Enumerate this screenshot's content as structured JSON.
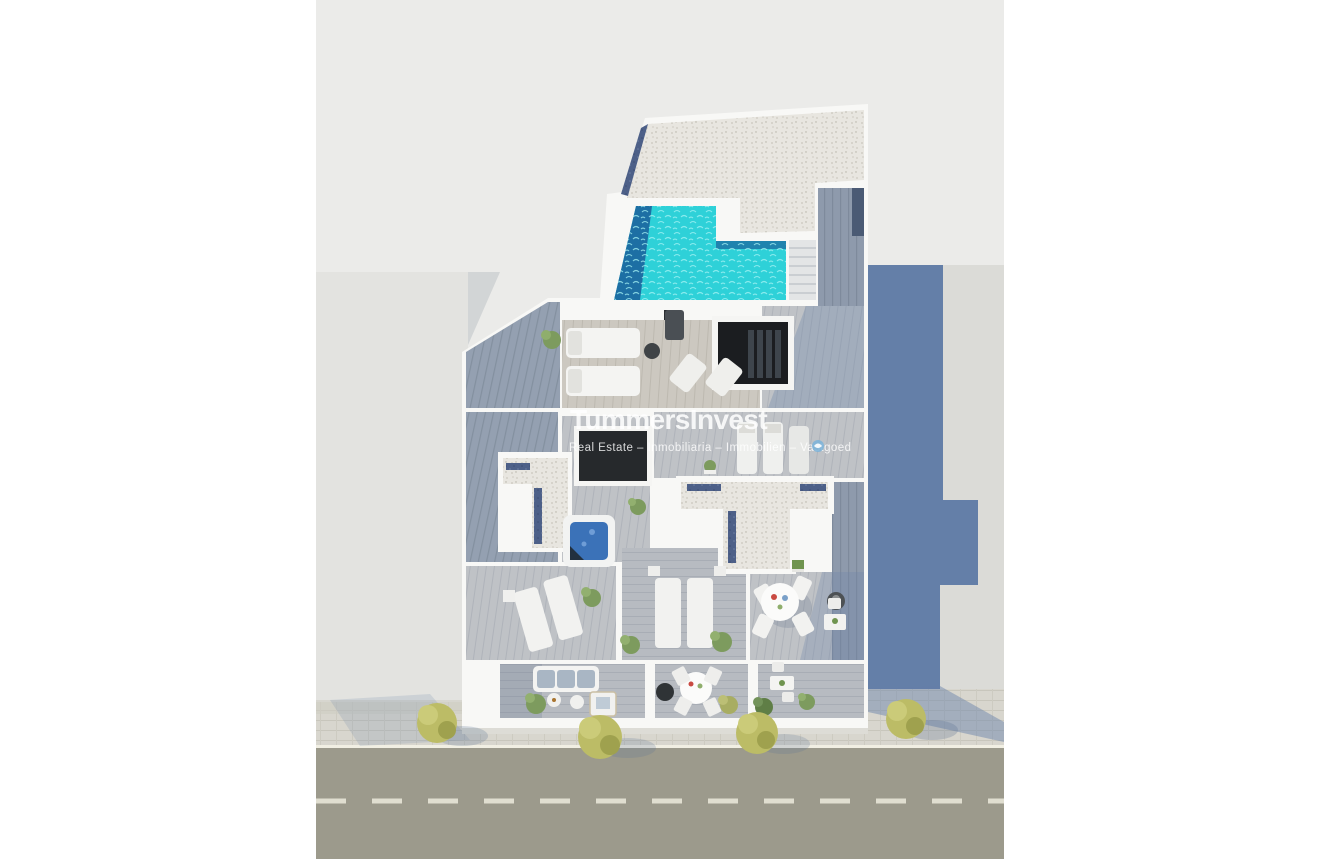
{
  "watermark": {
    "title": "TummersInvest",
    "subtitle": "Real Estate – Inmobiliaria – Immobilien – Vastgoed",
    "logo_icon": "swirl-bird-icon"
  },
  "scene": {
    "kind": "aerial 3D architectural render, top-down penthouse roof terrace floor plan",
    "objects": [
      "gravel-roof",
      "rooftop-pool",
      "pool-deck-stairs",
      "stairwell-skylight",
      "sun-loungers",
      "deck-chairs",
      "jacuzzi",
      "dark-skylight",
      "roof-terraces",
      "dining-table-round",
      "balcony-sofa",
      "balcony-daybed",
      "balcony-dining-set",
      "front-balconies",
      "sidewalk-trees",
      "street",
      "left-neighbor-building",
      "right-neighbor-building",
      "building-shadow"
    ]
  },
  "street": {
    "edge_line": "solid white",
    "center_line": "dashed white"
  },
  "colors": {
    "margin_white": "#ffffff",
    "backdrop": "#ebebe9",
    "left_building": "#e3e3e0",
    "right_building": "#dbdbd7",
    "shadow_blue": "#647fa8",
    "street": "#9c9a8c",
    "street_line": "#f1efe3",
    "street_dash": "#e8e6d8",
    "sidewalk": "#d8d6ce",
    "gravel": "#e8e6e0",
    "skylight_strip_navy": "#4d6088",
    "deck_shadow": "#94a0b1",
    "deck_light": "#b7bbc1",
    "terrace_sand": "#ccc8c0",
    "wall_white": "#f8f8f6",
    "pool_turquoise": "#2ed1d8",
    "pool_deep": "#1d6fa4",
    "jacuzzi_blue": "#3b72b8",
    "stairwell_dark": "#1b1d20",
    "skylight_dark": "#26292c",
    "tree_yellow": "#bcbc66",
    "plant_green": "#7d9b5e",
    "furniture_white": "#f4f4f2",
    "cushion_blue": "#a9b6c4"
  }
}
